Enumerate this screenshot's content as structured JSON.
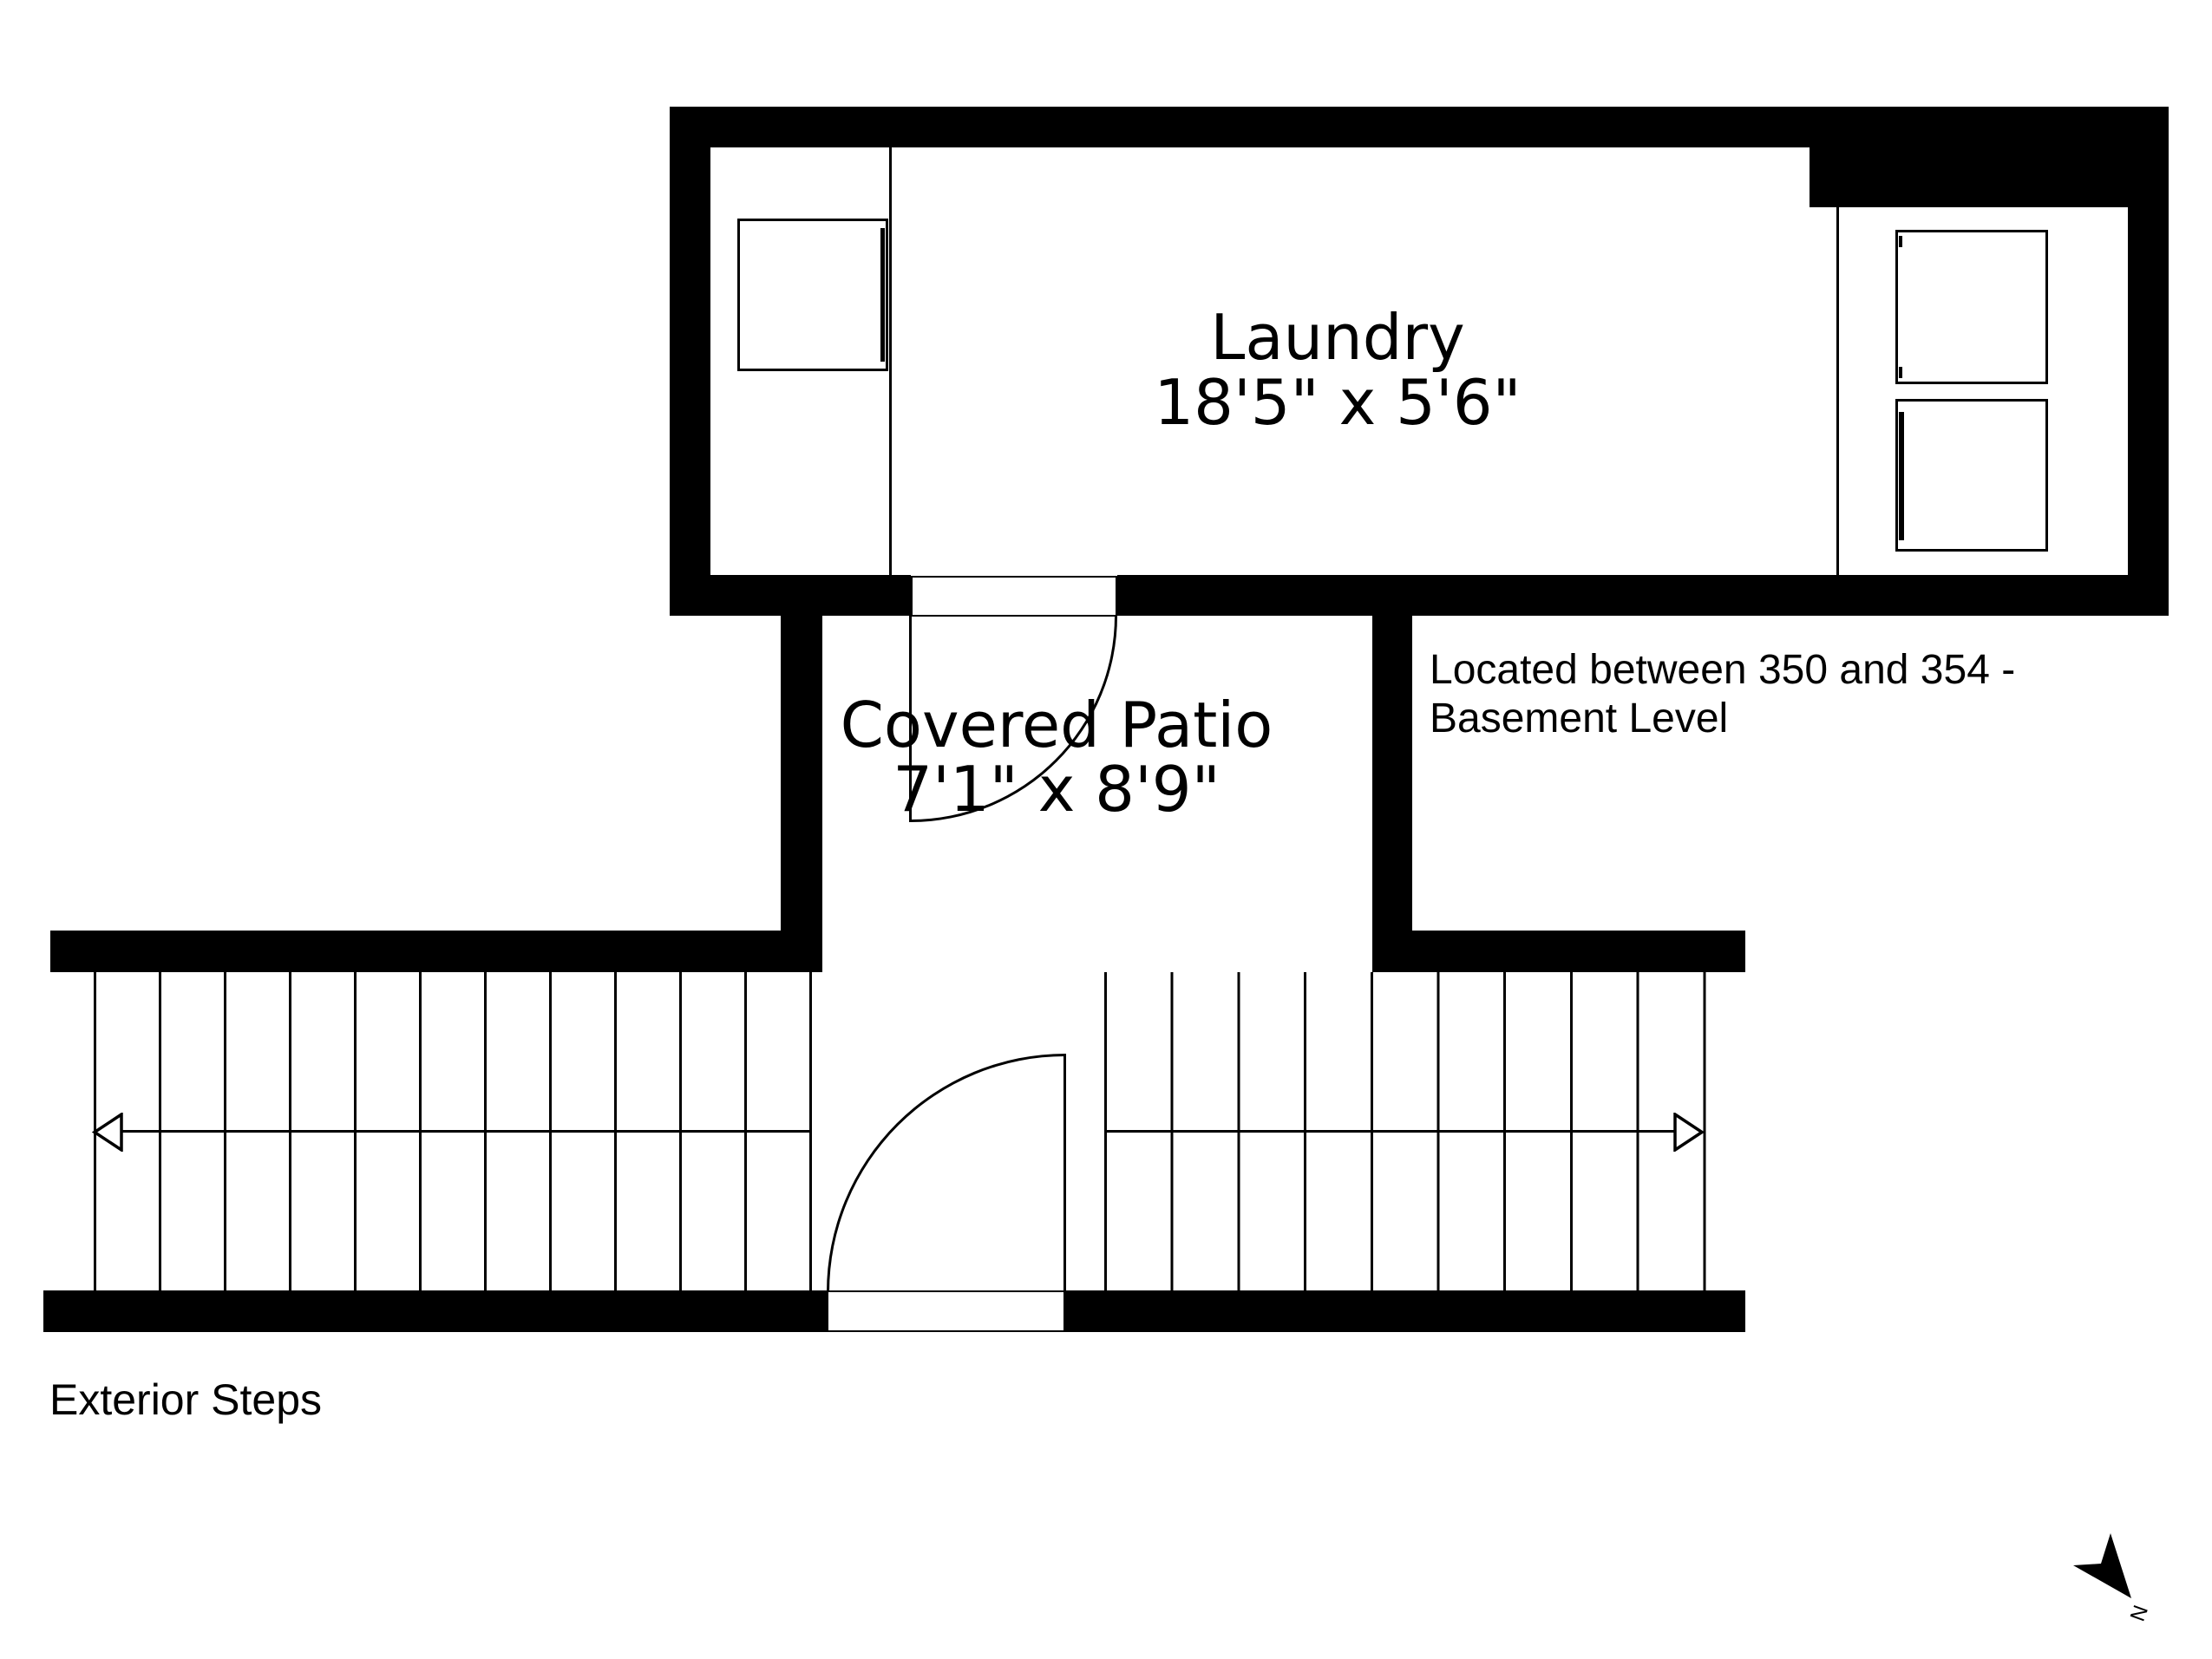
{
  "page": {
    "background": "#ffffff",
    "line_color": "#000000"
  },
  "rooms": {
    "laundry": {
      "name": "Laundry",
      "dimensions": "18'5\" x 5'6\""
    },
    "patio": {
      "name": "Covered Patio",
      "dimensions": "7'1\" x 8'9\""
    }
  },
  "notes": {
    "location": {
      "line1": "Located between 350 and 354 -",
      "line2": "Basement Level"
    },
    "steps_label": "Exterior Steps"
  },
  "compass": {
    "label": "N"
  },
  "stairs": {
    "left_flight_tread_lines": 12,
    "right_flight_tread_lines": 10
  }
}
